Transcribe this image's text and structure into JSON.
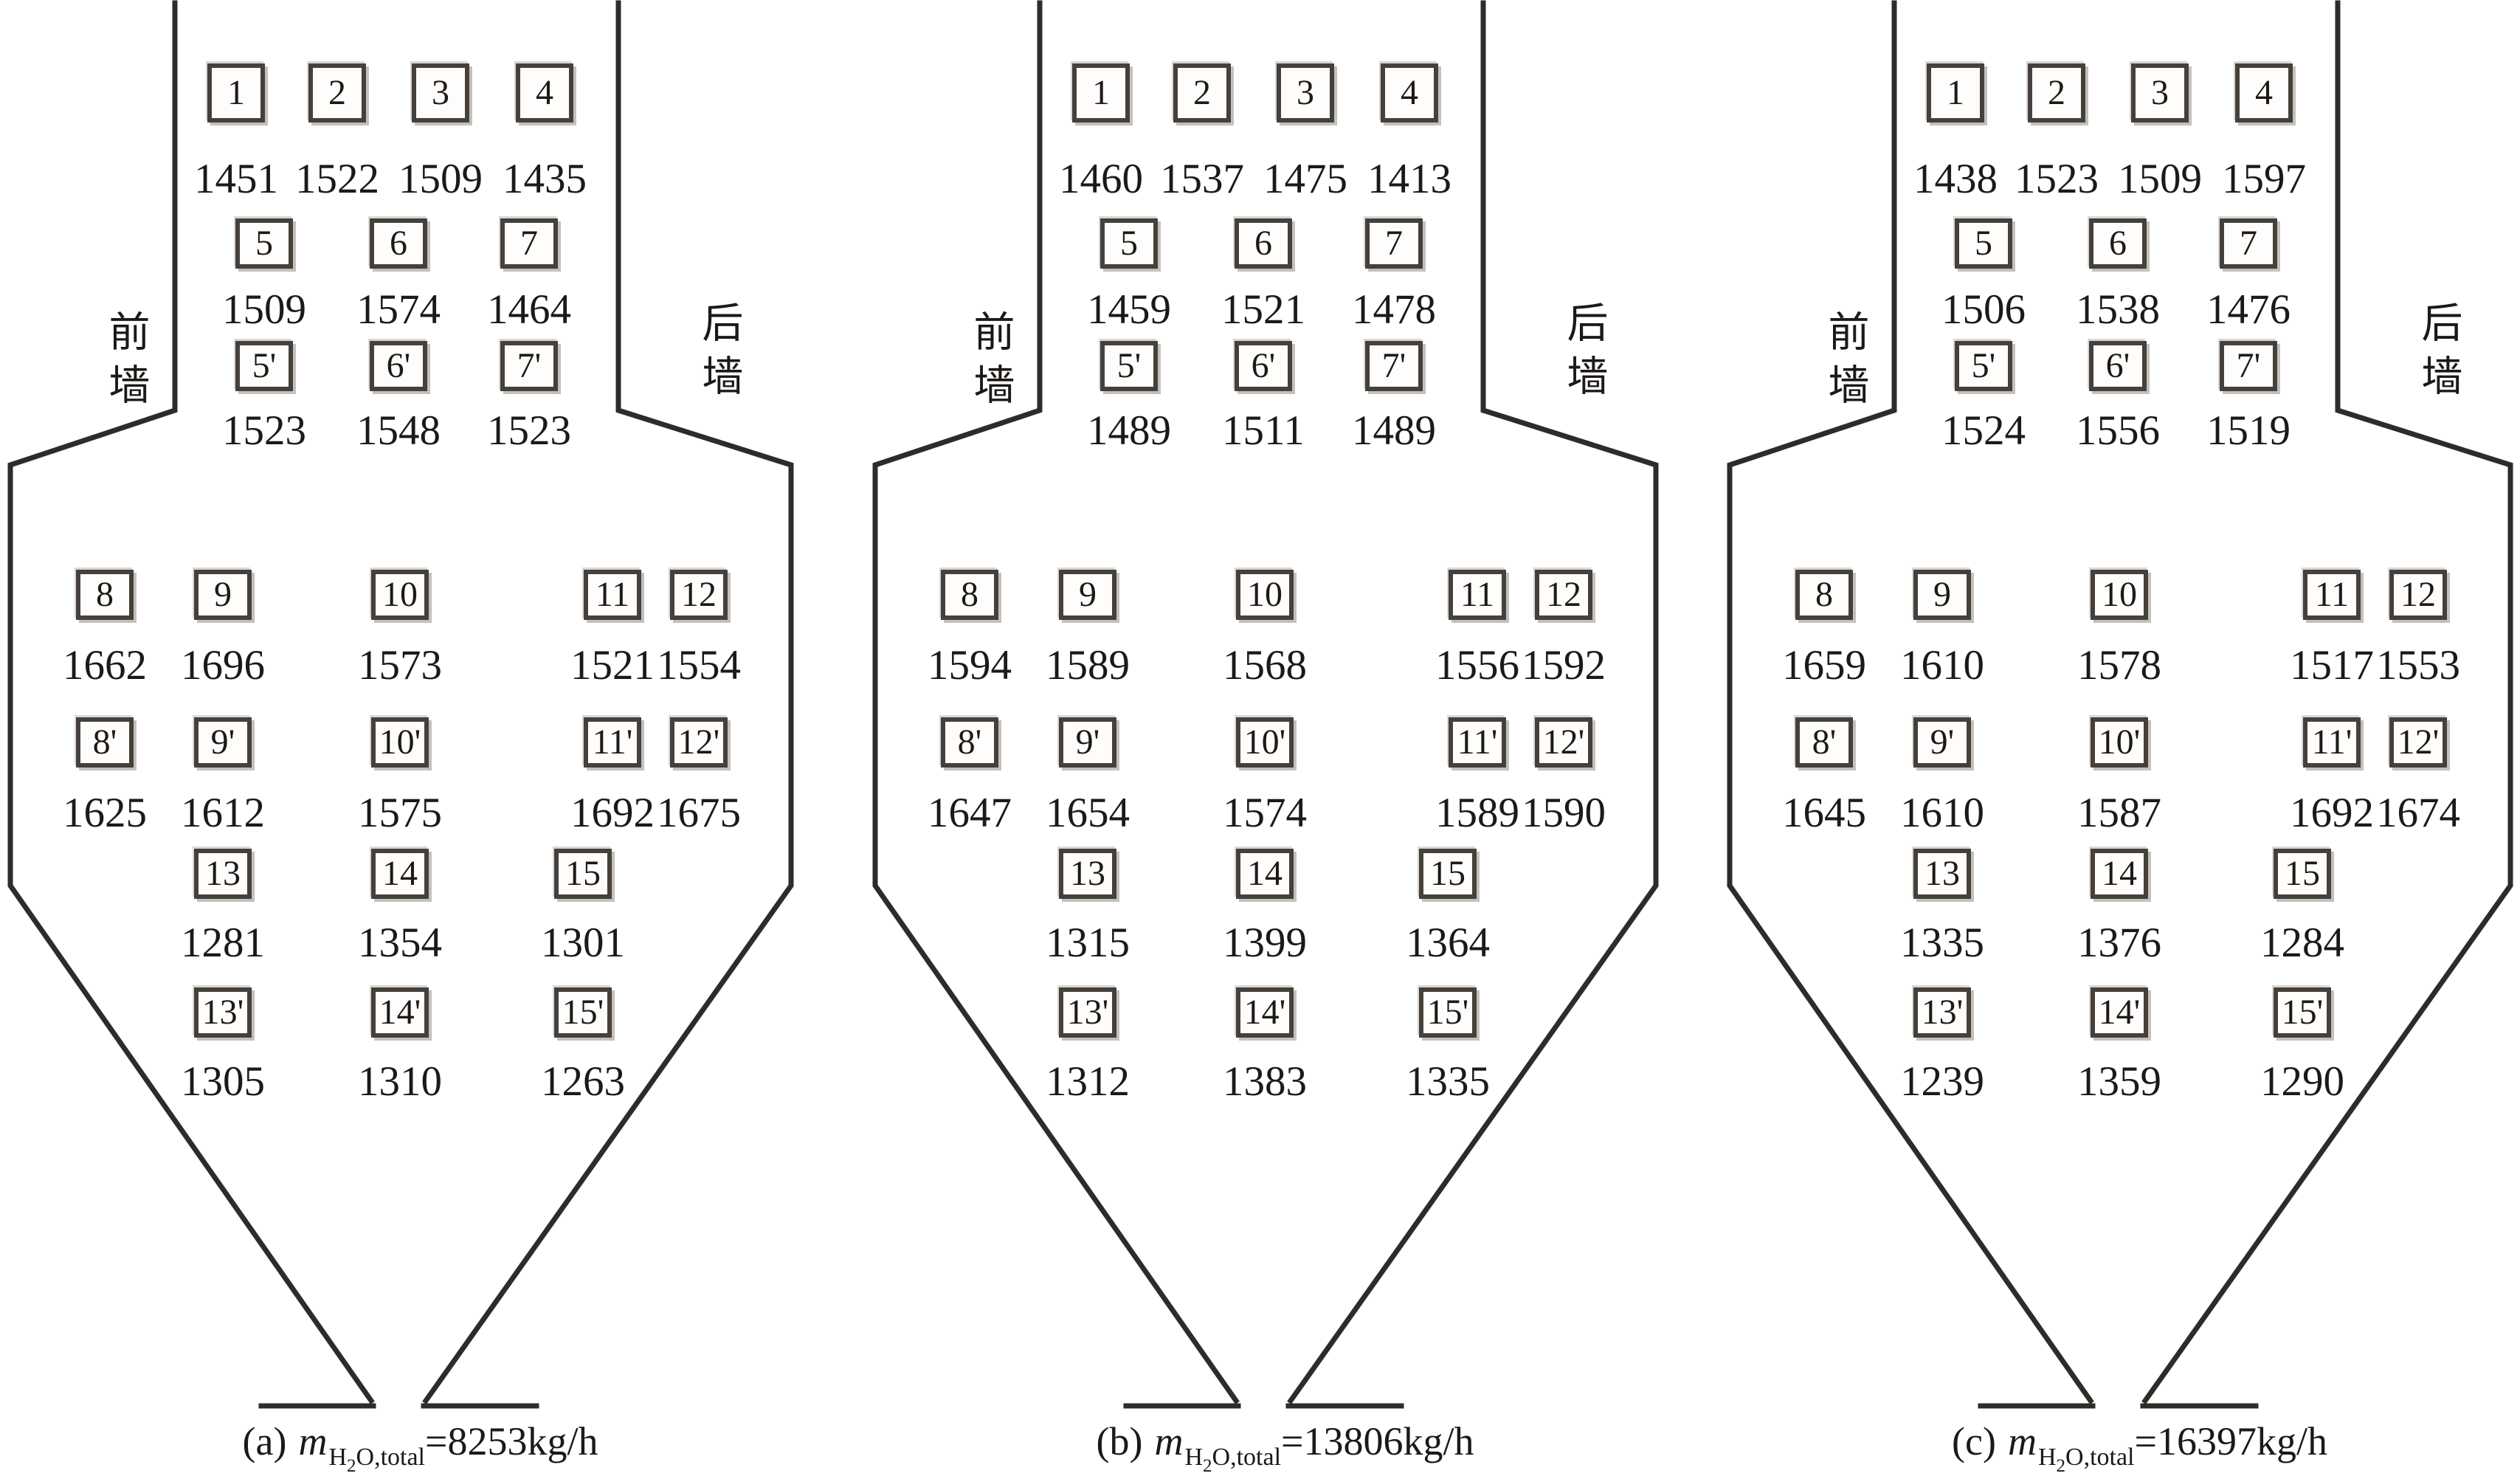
{
  "figure": {
    "colors": {
      "ink": "#1c1916",
      "outline": "#2e2b28",
      "box_border": "#45403b",
      "background": "#ffffff"
    },
    "wall_labels": {
      "front": "前墙",
      "rear": "后墙"
    },
    "panels": [
      {
        "id": "a",
        "caption": {
          "prefix": "(a)",
          "symbol": "m",
          "sub_h": "H",
          "sub_2": "2",
          "sub_rest": "O,total",
          "equation": "=8253kg/h"
        },
        "rows": [
          {
            "cells": [
              {
                "label": "1",
                "value": "1451"
              },
              {
                "label": "2",
                "value": "1522"
              },
              {
                "label": "3",
                "value": "1509"
              },
              {
                "label": "4",
                "value": "1435"
              }
            ]
          },
          {
            "cells": [
              {
                "label": "5",
                "value": "1509"
              },
              {
                "label": "6",
                "value": "1574"
              },
              {
                "label": "7",
                "value": "1464"
              }
            ]
          },
          {
            "cells": [
              {
                "label": "5'",
                "value": "1523"
              },
              {
                "label": "6'",
                "value": "1548"
              },
              {
                "label": "7'",
                "value": "1523"
              }
            ]
          },
          {
            "cells": [
              {
                "label": "8",
                "value": "1662"
              },
              {
                "label": "9",
                "value": "1696"
              },
              {
                "label": "10",
                "value": "1573"
              },
              {
                "label": "11",
                "value": "1521"
              },
              {
                "label": "12",
                "value": "1554"
              }
            ]
          },
          {
            "cells": [
              {
                "label": "8'",
                "value": "1625"
              },
              {
                "label": "9'",
                "value": "1612"
              },
              {
                "label": "10'",
                "value": "1575"
              },
              {
                "label": "11'",
                "value": "1692"
              },
              {
                "label": "12'",
                "value": "1675"
              }
            ]
          },
          {
            "cells": [
              {
                "label": "13",
                "value": "1281"
              },
              {
                "label": "14",
                "value": "1354"
              },
              {
                "label": "15",
                "value": "1301"
              }
            ]
          },
          {
            "cells": [
              {
                "label": "13'",
                "value": "1305"
              },
              {
                "label": "14'",
                "value": "1310"
              },
              {
                "label": "15'",
                "value": "1263"
              }
            ]
          }
        ]
      },
      {
        "id": "b",
        "caption": {
          "prefix": "(b)",
          "symbol": "m",
          "sub_h": "H",
          "sub_2": "2",
          "sub_rest": "O,total",
          "equation": "=13806kg/h"
        },
        "rows": [
          {
            "cells": [
              {
                "label": "1",
                "value": "1460"
              },
              {
                "label": "2",
                "value": "1537"
              },
              {
                "label": "3",
                "value": "1475"
              },
              {
                "label": "4",
                "value": "1413"
              }
            ]
          },
          {
            "cells": [
              {
                "label": "5",
                "value": "1459"
              },
              {
                "label": "6",
                "value": "1521"
              },
              {
                "label": "7",
                "value": "1478"
              }
            ]
          },
          {
            "cells": [
              {
                "label": "5'",
                "value": "1489"
              },
              {
                "label": "6'",
                "value": "1511"
              },
              {
                "label": "7'",
                "value": "1489"
              }
            ]
          },
          {
            "cells": [
              {
                "label": "8",
                "value": "1594"
              },
              {
                "label": "9",
                "value": "1589"
              },
              {
                "label": "10",
                "value": "1568"
              },
              {
                "label": "11",
                "value": "1556"
              },
              {
                "label": "12",
                "value": "1592"
              }
            ]
          },
          {
            "cells": [
              {
                "label": "8'",
                "value": "1647"
              },
              {
                "label": "9'",
                "value": "1654"
              },
              {
                "label": "10'",
                "value": "1574"
              },
              {
                "label": "11'",
                "value": "1589"
              },
              {
                "label": "12'",
                "value": "1590"
              }
            ]
          },
          {
            "cells": [
              {
                "label": "13",
                "value": "1315"
              },
              {
                "label": "14",
                "value": "1399"
              },
              {
                "label": "15",
                "value": "1364"
              }
            ]
          },
          {
            "cells": [
              {
                "label": "13'",
                "value": "1312"
              },
              {
                "label": "14'",
                "value": "1383"
              },
              {
                "label": "15'",
                "value": "1335"
              }
            ]
          }
        ]
      },
      {
        "id": "c",
        "caption": {
          "prefix": "(c)",
          "symbol": "m",
          "sub_h": "H",
          "sub_2": "2",
          "sub_rest": "O,total",
          "equation": "=16397kg/h"
        },
        "rows": [
          {
            "cells": [
              {
                "label": "1",
                "value": "1438"
              },
              {
                "label": "2",
                "value": "1523"
              },
              {
                "label": "3",
                "value": "1509"
              },
              {
                "label": "4",
                "value": "1597"
              }
            ]
          },
          {
            "cells": [
              {
                "label": "5",
                "value": "1506"
              },
              {
                "label": "6",
                "value": "1538"
              },
              {
                "label": "7",
                "value": "1476"
              }
            ]
          },
          {
            "cells": [
              {
                "label": "5'",
                "value": "1524"
              },
              {
                "label": "6'",
                "value": "1556"
              },
              {
                "label": "7'",
                "value": "1519"
              }
            ]
          },
          {
            "cells": [
              {
                "label": "8",
                "value": "1659"
              },
              {
                "label": "9",
                "value": "1610"
              },
              {
                "label": "10",
                "value": "1578"
              },
              {
                "label": "11",
                "value": "1517"
              },
              {
                "label": "12",
                "value": "1553"
              }
            ]
          },
          {
            "cells": [
              {
                "label": "8'",
                "value": "1645"
              },
              {
                "label": "9'",
                "value": "1610"
              },
              {
                "label": "10'",
                "value": "1587"
              },
              {
                "label": "11'",
                "value": "1692"
              },
              {
                "label": "12'",
                "value": "1674"
              }
            ]
          },
          {
            "cells": [
              {
                "label": "13",
                "value": "1335"
              },
              {
                "label": "14",
                "value": "1376"
              },
              {
                "label": "15",
                "value": "1284"
              }
            ]
          },
          {
            "cells": [
              {
                "label": "13'",
                "value": "1239"
              },
              {
                "label": "14'",
                "value": "1359"
              },
              {
                "label": "15'",
                "value": "1290"
              }
            ]
          }
        ]
      }
    ]
  }
}
